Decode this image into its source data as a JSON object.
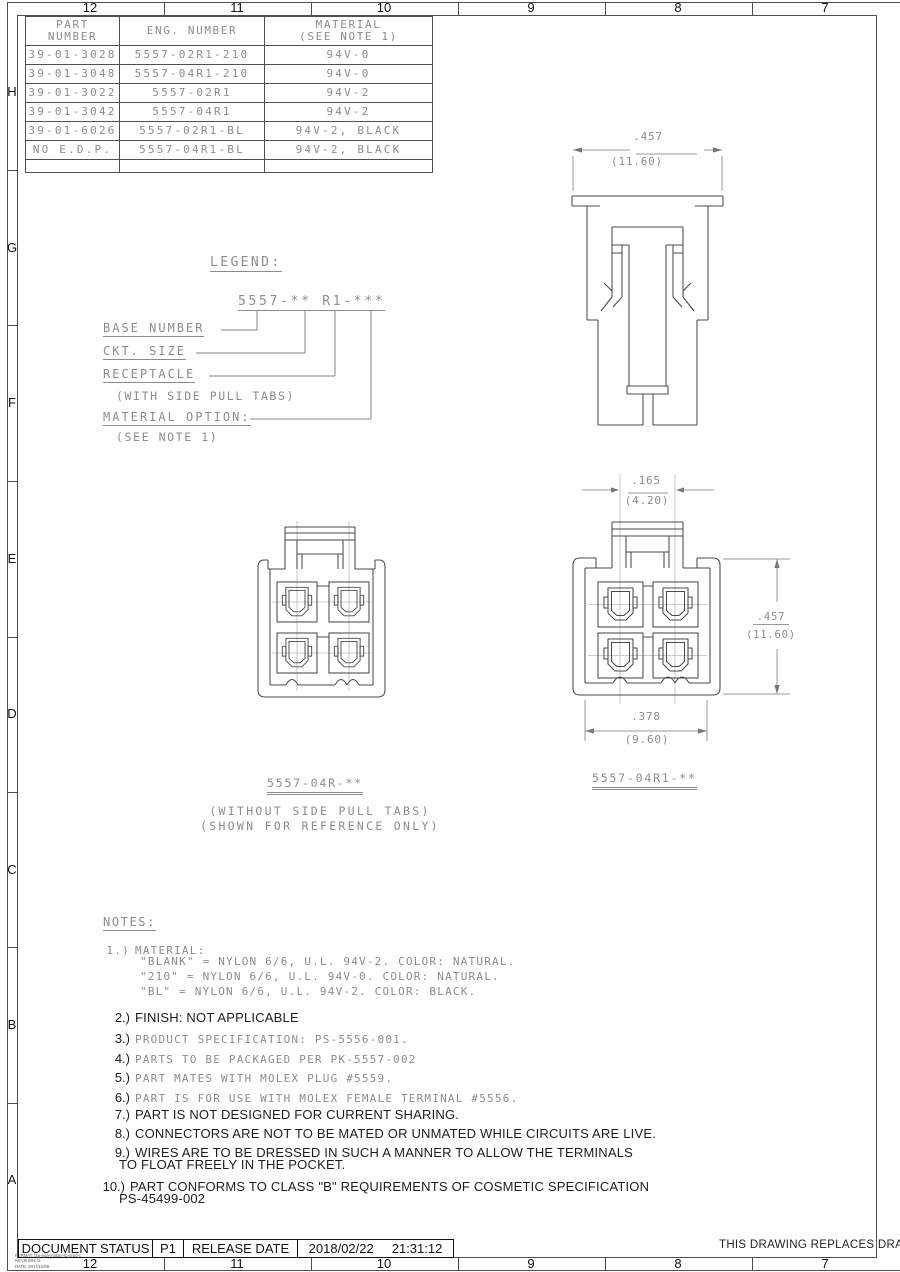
{
  "sheet": {
    "top_ruler": [
      "12",
      "11",
      "10",
      "9",
      "8",
      "7"
    ],
    "bottom_ruler": [
      "12",
      "11",
      "10",
      "9",
      "8",
      "7"
    ],
    "left_ruler": [
      "H",
      "G",
      "F",
      "E",
      "D",
      "C",
      "B",
      "A"
    ],
    "replaces_note": "THIS DRAWING REPLACES DRAW",
    "format_lines": [
      "FORMAT: brg-ega-master-tb-prod-c",
      "REVISION: D",
      "DATE: 2017/10/06"
    ]
  },
  "colors": {
    "line": "#4a4a4a",
    "cad_text": "#8c8c8c",
    "dark_text": "#1d1d1d"
  },
  "parts_table": {
    "header": {
      "part1": "PART",
      "part2": "NUMBER",
      "eng": "ENG. NUMBER",
      "mat1": "MATERIAL",
      "mat2": "(SEE NOTE 1)"
    },
    "rows": [
      {
        "part": "39-01-3028",
        "eng": "5557-02R1-210",
        "mat": "94V-0"
      },
      {
        "part": "39-01-3048",
        "eng": "5557-04R1-210",
        "mat": "94V-0"
      },
      {
        "part": "39-01-3022",
        "eng": "5557-02R1",
        "mat": "94V-2"
      },
      {
        "part": "39-01-3042",
        "eng": "5557-04R1",
        "mat": "94V-2"
      },
      {
        "part": "39-01-6026",
        "eng": "5557-02R1-BL",
        "mat": "94V-2, BLACK"
      },
      {
        "part": "NO E.D.P.",
        "eng": "5557-04R1-BL",
        "mat": "94V-2, BLACK"
      }
    ]
  },
  "legend": {
    "title": "LEGEND:",
    "code": "5557-** R1-***",
    "base": "BASE NUMBER",
    "ckt": "CKT. SIZE",
    "receptacle": "RECEPTACLE",
    "receptacle_sub": "(WITH SIDE PULL TABS)",
    "material": "MATERIAL OPTION:",
    "material_sub": "(SEE NOTE 1)"
  },
  "views": {
    "side_view": {
      "dim_in": ".457",
      "dim_mm": "(11.60)"
    },
    "front_right": {
      "label": "5557-04R1-**",
      "top_in": ".165",
      "top_mm": "(4.20)",
      "right_in": ".457",
      "right_mm": "(11.60)",
      "bottom_in": ".378",
      "bottom_mm": "(9.60)"
    },
    "front_left": {
      "label": "5557-04R-**",
      "caption1": "(WITHOUT SIDE PULL TABS)",
      "caption2": "(SHOWN FOR REFERENCE ONLY)"
    }
  },
  "notes": {
    "title": "NOTES:",
    "n1_num": "1.)",
    "n1_text": "MATERIAL:",
    "n1_subs": [
      "\"BLANK\" = NYLON 6/6, U.L. 94V-2. COLOR: NATURAL.",
      "\"210\" = NYLON 6/6, U.L. 94V-0. COLOR: NATURAL.",
      "\"BL\" = NYLON 6/6, U.L. 94V-2. COLOR: BLACK."
    ],
    "n2_num": "2.)",
    "n2_text": "FINISH: NOT APPLICABLE",
    "n3_num": "3.)",
    "n3_text": "PRODUCT SPECIFICATION: PS-5556-001.",
    "n4_num": "4.)",
    "n4_text": "PARTS TO BE PACKAGED PER PK-5557-002",
    "n5_num": "5.)",
    "n5_text": "PART MATES WITH MOLEX PLUG #5559.",
    "n6_num": "6.)",
    "n6_text": "PART IS FOR USE WITH MOLEX FEMALE TERMINAL #5556.",
    "n7_num": "7.)",
    "n7_text": "PART IS NOT DESIGNED FOR CURRENT SHARING.",
    "n8_num": "8.)",
    "n8_text": "CONNECTORS ARE NOT TO BE MATED OR UNMATED WHILE CIRCUITS ARE LIVE.",
    "n9_num": "9.)",
    "n9_text": "WIRES ARE TO BE DRESSED IN SUCH A MANNER TO ALLOW THE TERMINALS",
    "n9_cont": "TO FLOAT FREELY IN THE POCKET.",
    "n10_num": "10.)",
    "n10_text": "PART CONFORMS TO CLASS \"B\" REQUIREMENTS OF COSMETIC SPECIFICATION",
    "n10_cont": "PS-45499-002"
  },
  "status_bar": {
    "label": "DOCUMENT STATUS",
    "status": "P1",
    "release_label": "RELEASE DATE",
    "date": "2018/02/22",
    "time": "21:31:12"
  }
}
